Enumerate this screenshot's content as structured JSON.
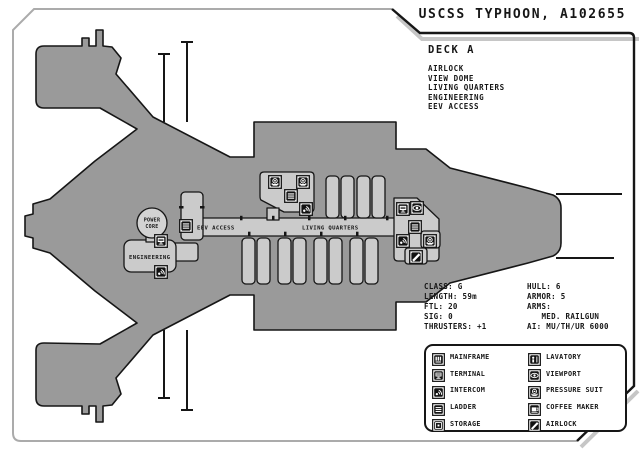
{
  "title": "USCSS TYPHOON, A102655",
  "deck": {
    "heading": "DECK A",
    "features": [
      "AIRLOCK",
      "VIEW DOME",
      "LIVING QUARTERS",
      "ENGINEERING",
      "EEV ACCESS"
    ]
  },
  "stats": {
    "left": [
      "CLASS: G",
      "LENGTH: 59m",
      "FTL: 20",
      "SIG: 0",
      "THRUSTERS: +1"
    ],
    "right": [
      "HULL: 6",
      "ARMOR: 5",
      "ARMS:",
      "   MED. RAILGUN",
      "AI: MU/TH/UR 6000"
    ]
  },
  "ship": {
    "labels": {
      "power_core_line1": "POWER",
      "power_core_line2": "CORE",
      "engineering": "ENGINEERING",
      "eev_access": "EEV ACCESS",
      "living_quarters": "LIVING QUARTERS"
    },
    "icons": [
      {
        "type": "terminal",
        "x": 161,
        "y": 240
      },
      {
        "type": "intercom",
        "x": 161,
        "y": 271
      },
      {
        "type": "ladder",
        "x": 186,
        "y": 225
      },
      {
        "type": "pressure-suit",
        "x": 275,
        "y": 181
      },
      {
        "type": "pressure-suit",
        "x": 303,
        "y": 181
      },
      {
        "type": "ladder",
        "x": 291,
        "y": 195
      },
      {
        "type": "intercom",
        "x": 306,
        "y": 208
      },
      {
        "type": "terminal",
        "x": 403,
        "y": 208
      },
      {
        "type": "viewport",
        "x": 417,
        "y": 207
      },
      {
        "type": "ladder",
        "x": 415,
        "y": 226
      },
      {
        "type": "intercom",
        "x": 403,
        "y": 240
      },
      {
        "type": "pressure-suit",
        "x": 430,
        "y": 240
      },
      {
        "type": "airlock",
        "x": 416,
        "y": 256
      }
    ]
  },
  "legend": {
    "left": [
      {
        "icon": "mainframe",
        "label": "MAINFRAME"
      },
      {
        "icon": "terminal",
        "label": "TERMINAL"
      },
      {
        "icon": "intercom",
        "label": "INTERCOM"
      },
      {
        "icon": "ladder",
        "label": "LADDER"
      },
      {
        "icon": "storage",
        "label": "STORAGE"
      }
    ],
    "right": [
      {
        "icon": "lavatory",
        "label": "LAVATORY"
      },
      {
        "icon": "viewport",
        "label": "VIEWPORT"
      },
      {
        "icon": "pressure-suit",
        "label": "PRESSURE SUIT"
      },
      {
        "icon": "coffee-maker",
        "label": "COFFEE MAKER"
      },
      {
        "icon": "airlock",
        "label": "AIRLOCK"
      }
    ]
  },
  "colors": {
    "hull": "#9a9a9a",
    "room": "#cbcbcb",
    "power_core": "#d3d3d3",
    "outline": "#161616",
    "frame_gray": "#ababab",
    "shadow": "#c6c6c6",
    "text": "#161616",
    "page": "#ffffff"
  }
}
